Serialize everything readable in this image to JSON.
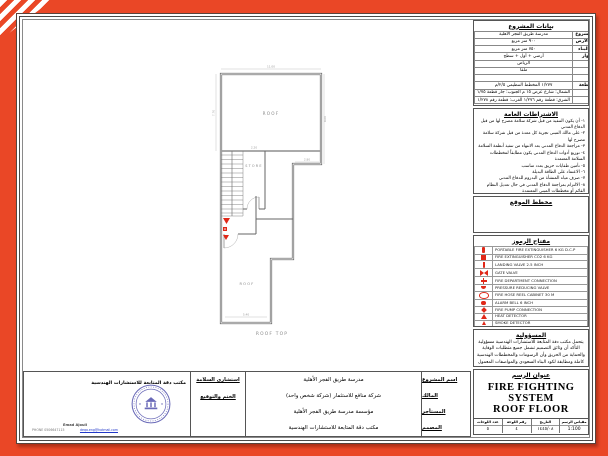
{
  "colors": {
    "accent": "#EA4726",
    "line": "#4a4a4a",
    "symbol_red": "#E02818",
    "symbol_cyan": "#18C4DE",
    "stamp_blue": "#6A6AB8",
    "email_blue": "#2238C8"
  },
  "plan": {
    "label_roof_upper": "ROOF",
    "label_roof_lower": "ROOF",
    "label_store": "STORE",
    "label_roof_top": "ROOF TOP",
    "dimensions": [
      "11.00",
      "7.70",
      "9.00",
      "2.80",
      "2.20",
      "5.40"
    ]
  },
  "title_block": {
    "project_data": {
      "header": "بيانات المشروع",
      "rows": [
        {
          "label": "اسم المشروع",
          "value": "مدرسة طريق الفجر الأهلية"
        },
        {
          "label": "مساحة الأرض",
          "value": "٩٠٠ متر مربع"
        },
        {
          "label": "مساحة البناء",
          "value": "٧٥٠ متر مربع"
        },
        {
          "label": "عدد الأدوار",
          "value": "أرضي + أول + سطح"
        },
        {
          "label": "المدينة",
          "value": "الرياض"
        },
        {
          "label": "الحي",
          "value": "ملقا"
        },
        {
          "label": "الشارع",
          "value": ""
        },
        {
          "label": "رقم القطعة",
          "value": "١/٢٧٧   المخطط التنظيمي ٢/٥/م"
        },
        {
          "label": "الحدود",
          "value": "الشمال: شارع عرض ١٥ م   الجنوب: جار قطعة ١/٧٥"
        },
        {
          "label": "التاريخ",
          "value": "الشرق: قطعة رقم ١/٢٧٦   الغرب: قطعة رقم ١/٢٧٨"
        }
      ]
    },
    "general_notes": {
      "header": "الاشتراطات العامة",
      "items": [
        "١- أن يكون التنفيذ من قبل شركة سلامة مصرح لها من قبل الدفاع المدني",
        "٢- على مالك المبنى تجربة كل معدة من قبل شركة سلامة مصرح لها",
        "٣- مراجعة الدفاع المدني بعد الانتهاء من تنفيذ أنظمة السلامة",
        "٤- توزيع أدوات الدفاع المدني يكون مطابقاً لمخططات السلامة المعتمدة",
        "٥- تأمين طفايات حريق بعدد مناسب",
        "٦- الاعتماد على الطاقة البديلة",
        "٧- صرف مياه المنشأة من البدروم للدفاع المدني",
        "٨- الالتزام بمراجعة الدفاع المدني في حال تعديل النظام القائم أو مخططات المبنى المعتمدة",
        "٩- تركيب إنارة للطوارئ بالمبنى",
        "١٠- عمل مخارج للطوارئ وفق المتطلبات"
      ]
    },
    "site_plan": {
      "header": "مخطط الموقع"
    },
    "legend": {
      "header": "مفتاح الرموز",
      "items": [
        {
          "icon": "fire-extinguisher-dcp",
          "color": "#E02818",
          "label": "PORTABLE FIRE EXTINGUISHER 6 KG D.C.P"
        },
        {
          "icon": "fire-extinguisher-co2",
          "color": "#E02818",
          "label": "FIRE EXTINGUISHER CO2 6 KG"
        },
        {
          "icon": "landing-valve",
          "color": "#E02818",
          "label": "LANDING VALVE 2.5 INCH"
        },
        {
          "icon": "gate-valve",
          "color": "#E02818",
          "label": "GATE VALVE"
        },
        {
          "icon": "fire-department-connection",
          "color": "#E02818",
          "label": "FIRE DEPARTMENT CONNECTION"
        },
        {
          "icon": "pressure-reducing-valve",
          "color": "#E02818",
          "label": "PRESSURE REDUCING VALVE"
        },
        {
          "icon": "fire-hose-reel",
          "color": "#E02818",
          "label": "FIRE HOSE REEL CABINET 30 M"
        },
        {
          "icon": "alarm-bell",
          "color": "#E02818",
          "label": "ALARM BELL 6 INCH"
        },
        {
          "icon": "fire-pump",
          "color": "#E02818",
          "label": "FIRE PUMP CONNECTION"
        },
        {
          "icon": "heat-detector",
          "color": "#E02818",
          "label": "HEAT DETECTOR"
        },
        {
          "icon": "smoke-detector",
          "color": "#E02818",
          "label": "SMOKE DETECTOR"
        },
        {
          "icon": "wet-riser-pipe",
          "color": "#18C4DE",
          "label": "AUTOMATIC WET RISER PIPE"
        }
      ]
    },
    "responsibility": {
      "header": "المسؤولية",
      "text": "يتحمل مكتب دقة المتابعة للاستشارات الهندسية مسؤولية التأكد أن وثائق التصميم تشمل جميع متطلبات الوقاية والحماية من الحريق وأن الرسومات والمخططات الهندسية كاملة ومطابقة لكود البناء السعودي والمواصفات المعمول بها"
    },
    "drawing_title": {
      "header": "عنوان الرسم",
      "line1": "FIRE FIGHTING SYSTEM",
      "line2": "ROOF FLOOR",
      "info_cells": [
        {
          "label": "مقياس الرسم",
          "value": "1:100"
        },
        {
          "label": "التاريخ",
          "value": "١٤٤٥/٠٨"
        },
        {
          "label": "رقم اللوحة",
          "value": "٤"
        },
        {
          "label": "عدد اللوحات",
          "value": "٥"
        }
      ]
    }
  },
  "bottom_block": {
    "rows": [
      {
        "label": "اسم المشروع",
        "value": "مدرسة طريق الفجر الأهلية"
      },
      {
        "label": "المالك",
        "value": "شركة منافع للاستثمار (شركة شخص واحد)"
      },
      {
        "label": "المستأجر",
        "value": "مؤسسة مدرسة طريق الفجر الأهلية"
      },
      {
        "label": "المصمم",
        "value": "مكتب دقة المتابعة للاستشارات الهندسية"
      }
    ],
    "consultant_label": "استشاري السلامة",
    "stamp_label": "الختم والتوقيع",
    "company_name": "مكتب دقة المتابعة للاستشارات الهندسية",
    "contact": {
      "name": "Emad Ajouli",
      "phone": "PHONE 0506647115",
      "email": "deqa.eng@hotmail.com"
    }
  }
}
